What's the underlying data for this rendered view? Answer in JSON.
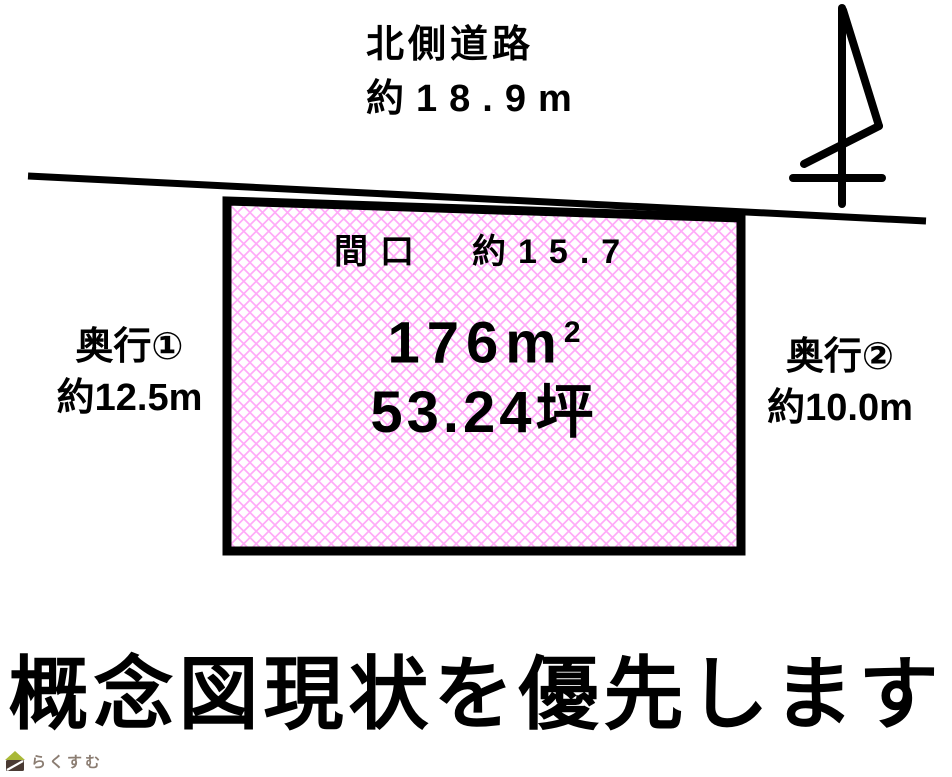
{
  "north_road": {
    "label": "北側道路",
    "dimension": "約18.9m"
  },
  "plot": {
    "frontage_label": "間口　約15.7",
    "area_value": "176",
    "area_unit_base": "m",
    "area_unit_exponent": "2",
    "area_tsubo": "53.24坪",
    "hatch_color": "#ffaaf8",
    "border_color": "#000000",
    "fill_background": "#ffffff"
  },
  "left_depth": {
    "label": "奥行①",
    "dimension": "約12.5m"
  },
  "right_depth": {
    "label": "奥行②",
    "dimension": "約10.0m"
  },
  "footer": {
    "headline": "概念図現状を優先します"
  },
  "logo": {
    "text": "らくすむ",
    "roof_color": "#a9b838",
    "body_color": "#4a3a33",
    "text_color": "#8b7d72"
  }
}
